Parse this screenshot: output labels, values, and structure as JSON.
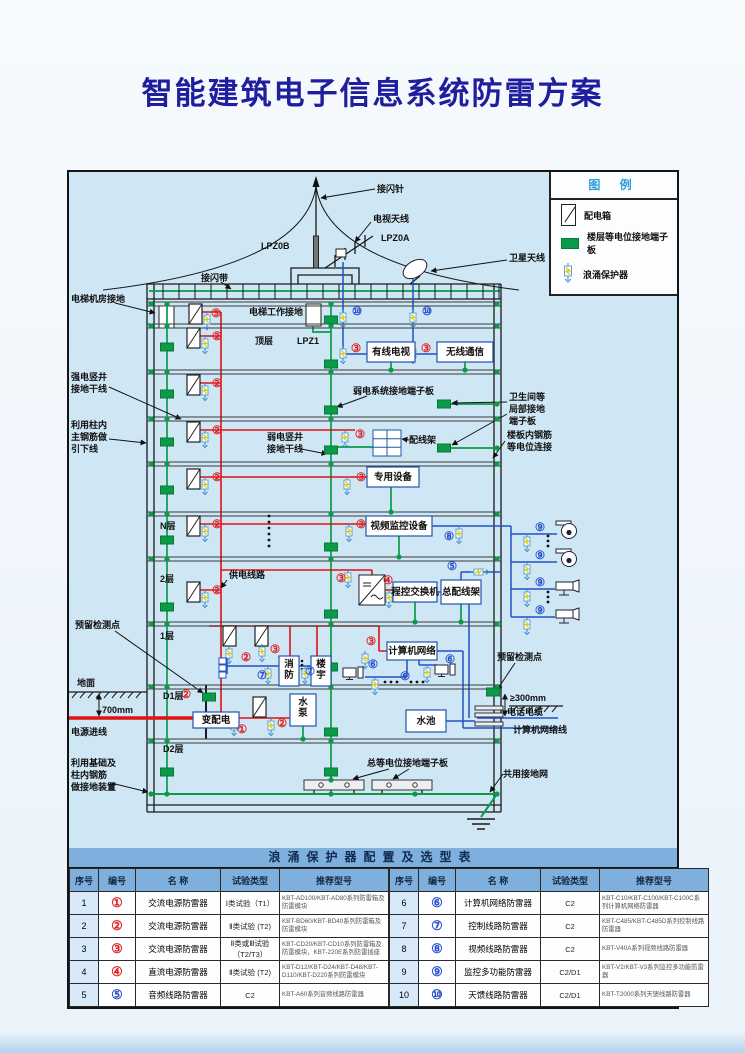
{
  "page": {
    "title": "智能建筑电子信息系统防雷方案"
  },
  "colors": {
    "wire_red": "#e01212",
    "wire_blue": "#2250c8",
    "wire_green": "#0a9a48",
    "marker_red": "#e02020",
    "marker_blue": "#2a50cc",
    "panel_bg": "#cfe7f5",
    "title_color": "#1e1e9e",
    "legend_title_color": "#2b9fd6",
    "table_header_bg": "#7fb0dd",
    "seq_col_bg": "#d8eafa"
  },
  "legend": {
    "title": "图 例",
    "items": [
      {
        "icon": "distribution-box-icon",
        "label": "配电箱"
      },
      {
        "icon": "floor-terminal-icon",
        "label": "楼层等电位接地端子板"
      },
      {
        "icon": "spd-icon",
        "label": "浪涌保护器"
      }
    ]
  },
  "diagram": {
    "slab_ys": [
      130,
      152,
      198,
      245,
      290,
      340,
      385,
      450,
      513,
      567
    ],
    "dot_xs": [
      82,
      262,
      428
    ],
    "riser_dot_x": 98,
    "labels": [
      [
        "接闪针",
        308,
        20
      ],
      [
        "电视天线",
        304,
        50
      ],
      [
        "LPZ0A",
        312,
        69
      ],
      [
        "LPZ0B",
        192,
        77
      ],
      [
        "卫星天线",
        440,
        89
      ],
      [
        "接闪带",
        132,
        109
      ],
      [
        "电梯机房接地",
        2,
        130
      ],
      [
        "电梯工作接地",
        180,
        143
      ],
      [
        "顶层",
        186,
        172
      ],
      [
        "LPZ1",
        228,
        172
      ],
      [
        "强电竖井",
        2,
        208
      ],
      [
        "接地干线",
        2,
        220
      ],
      [
        "利用柱内",
        2,
        256
      ],
      [
        "主钢筋做",
        2,
        268
      ],
      [
        "引下线",
        2,
        280
      ],
      [
        "弱电系统接地端子板",
        284,
        222
      ],
      [
        "弱电竖井",
        198,
        268
      ],
      [
        "接地干线",
        198,
        280
      ],
      [
        "配线架",
        340,
        271
      ],
      [
        "卫生间等",
        440,
        228
      ],
      [
        "局部接地",
        440,
        240
      ],
      [
        "端子板",
        440,
        252
      ],
      [
        "楼板内钢筋",
        438,
        266
      ],
      [
        "等电位连接",
        438,
        278
      ],
      [
        "N层",
        91,
        357
      ],
      [
        "供电线路",
        160,
        406
      ],
      [
        "2层",
        91,
        410
      ],
      [
        "1层",
        91,
        467
      ],
      [
        "D1层",
        94,
        527
      ],
      [
        "D2层",
        94,
        580
      ],
      [
        "预留检测点",
        6,
        456
      ],
      [
        "地面",
        8,
        514
      ],
      [
        "700mm",
        33,
        541
      ],
      [
        "电源进线",
        2,
        563
      ],
      [
        "利用基础及",
        2,
        594
      ],
      [
        "柱内钢筋",
        2,
        606
      ],
      [
        "做接地装置",
        2,
        618
      ],
      [
        "总等电位接地端子板",
        298,
        594
      ],
      [
        "预留检测点",
        428,
        488
      ],
      [
        "≥300mm",
        441,
        529
      ],
      [
        "电话电缆",
        438,
        543
      ],
      [
        "计算机网络线",
        444,
        561
      ],
      [
        "共用接地网",
        434,
        605
      ]
    ],
    "markers": [
      [
        "③",
        147,
        145,
        "r"
      ],
      [
        "⑩",
        288,
        143,
        "b"
      ],
      [
        "⑩",
        358,
        143,
        "b"
      ],
      [
        "②",
        148,
        168,
        "r"
      ],
      [
        "③",
        287,
        180,
        "r"
      ],
      [
        "③",
        357,
        180,
        "r"
      ],
      [
        "②",
        148,
        215,
        "r"
      ],
      [
        "②",
        148,
        262,
        "r"
      ],
      [
        "③",
        291,
        266,
        "r"
      ],
      [
        "②",
        148,
        309,
        "r"
      ],
      [
        "③",
        292,
        309,
        "r"
      ],
      [
        "②",
        148,
        356,
        "r"
      ],
      [
        "③",
        292,
        356,
        "r"
      ],
      [
        "⑧",
        380,
        368,
        "b"
      ],
      [
        "②",
        148,
        422,
        "r"
      ],
      [
        "③",
        272,
        410,
        "r"
      ],
      [
        "④",
        319,
        412,
        "r"
      ],
      [
        "⑤",
        383,
        398,
        "b"
      ],
      [
        "②",
        177,
        489,
        "r"
      ],
      [
        "③",
        206,
        481,
        "r"
      ],
      [
        "③",
        302,
        473,
        "r"
      ],
      [
        "⑦",
        193,
        507,
        "b"
      ],
      [
        "⑦",
        241,
        503,
        "b"
      ],
      [
        "⑥",
        304,
        496,
        "b"
      ],
      [
        "⑥",
        336,
        508,
        "b"
      ],
      [
        "⑥",
        381,
        491,
        "b"
      ],
      [
        "②",
        117,
        526,
        "r"
      ],
      [
        "①",
        173,
        561,
        "r"
      ],
      [
        "②",
        213,
        555,
        "r"
      ],
      [
        "⑨",
        471,
        359,
        "b"
      ],
      [
        "⑨",
        471,
        387,
        "b"
      ],
      [
        "⑨",
        471,
        414,
        "b"
      ],
      [
        "⑨",
        471,
        442,
        "b"
      ]
    ],
    "equipment": [
      [
        "有线电视",
        298,
        170,
        48,
        20,
        0
      ],
      [
        "无线通信",
        368,
        170,
        56,
        20,
        0
      ],
      [
        "专用设备",
        298,
        295,
        52,
        20,
        0
      ],
      [
        "视频监控设备",
        297,
        344,
        66,
        20,
        0
      ],
      [
        "程控交换机",
        324,
        410,
        44,
        20,
        0
      ],
      [
        "总配线架",
        372,
        408,
        40,
        24,
        0
      ],
      [
        "计算机网络",
        318,
        470,
        50,
        18,
        0
      ],
      [
        "水池",
        337,
        538,
        40,
        22,
        0
      ],
      [
        "变配电",
        124,
        540,
        46,
        16,
        0
      ],
      [
        "消防",
        210,
        484,
        20,
        30,
        1
      ],
      [
        "楼宇",
        242,
        484,
        20,
        30,
        1
      ],
      [
        "水泵",
        221,
        522,
        26,
        32,
        1
      ]
    ],
    "dist_boxes": [
      [
        120,
        132
      ],
      [
        118,
        156
      ],
      [
        118,
        203
      ],
      [
        118,
        250
      ],
      [
        118,
        297
      ],
      [
        118,
        344
      ],
      [
        118,
        410
      ],
      [
        154,
        454
      ],
      [
        186,
        454
      ],
      [
        184,
        525
      ]
    ],
    "spds": [
      [
        138,
        140,
        0
      ],
      [
        136,
        164,
        0
      ],
      [
        136,
        211,
        0
      ],
      [
        136,
        258,
        0
      ],
      [
        136,
        305,
        0
      ],
      [
        136,
        352,
        0
      ],
      [
        136,
        418,
        0
      ],
      [
        274,
        138,
        0
      ],
      [
        344,
        138,
        0
      ],
      [
        274,
        174,
        0
      ],
      [
        344,
        174,
        0
      ],
      [
        276,
        258,
        0
      ],
      [
        278,
        305,
        0
      ],
      [
        280,
        352,
        0
      ],
      [
        279,
        398,
        0
      ],
      [
        320,
        418,
        0
      ],
      [
        160,
        474,
        0
      ],
      [
        193,
        472,
        0
      ],
      [
        296,
        479,
        0
      ],
      [
        199,
        494,
        0
      ],
      [
        236,
        494,
        0
      ],
      [
        306,
        505,
        0
      ],
      [
        358,
        493,
        0
      ],
      [
        165,
        546,
        0
      ],
      [
        202,
        546,
        0
      ],
      [
        458,
        362,
        0
      ],
      [
        458,
        390,
        0
      ],
      [
        458,
        417,
        0
      ],
      [
        458,
        445,
        0
      ],
      [
        390,
        354,
        0
      ],
      [
        402,
        400,
        1
      ]
    ],
    "squares": [
      [
        98,
        175
      ],
      [
        98,
        222
      ],
      [
        98,
        270
      ],
      [
        98,
        318
      ],
      [
        98,
        368
      ],
      [
        98,
        435
      ],
      [
        98,
        600
      ],
      [
        262,
        148
      ],
      [
        262,
        192
      ],
      [
        262,
        238
      ],
      [
        262,
        278
      ],
      [
        262,
        375
      ],
      [
        262,
        442
      ],
      [
        262,
        495
      ],
      [
        262,
        560
      ],
      [
        262,
        600
      ],
      [
        375,
        232
      ],
      [
        375,
        276
      ],
      [
        424,
        520
      ],
      [
        140,
        525
      ]
    ],
    "extra_dots": [
      [
        82,
        622
      ],
      [
        98,
        622
      ],
      [
        262,
        622
      ],
      [
        346,
        622
      ],
      [
        428,
        622
      ],
      [
        322,
        198
      ],
      [
        396,
        198
      ],
      [
        322,
        340
      ],
      [
        330,
        385
      ],
      [
        346,
        450
      ],
      [
        392,
        450
      ],
      [
        234,
        567
      ],
      [
        428,
        232
      ],
      [
        428,
        276
      ],
      [
        262,
        608
      ]
    ],
    "cameras": [
      [
        500,
        358,
        "dome"
      ],
      [
        500,
        386,
        "dome"
      ],
      [
        498,
        414,
        "bullet"
      ],
      [
        498,
        442,
        "bullet"
      ]
    ],
    "computers": [
      [
        274,
        496
      ],
      [
        366,
        493
      ]
    ],
    "sensors": [
      [
        150,
        486
      ],
      [
        150,
        493
      ],
      [
        150,
        500
      ]
    ],
    "bus_bars": [
      [
        235,
        608
      ],
      [
        303,
        608
      ]
    ],
    "vdots": [
      [
        200,
        344,
        6,
        6
      ],
      [
        479,
        364,
        5,
        3
      ],
      [
        479,
        420,
        5,
        3
      ]
    ],
    "hdots": [
      [
        316,
        510,
        6,
        3
      ],
      [
        342,
        510,
        6,
        3
      ]
    ]
  },
  "table": {
    "title": "浪涌保护器配置及选型表",
    "headers": [
      "序号",
      "编号",
      "名 称",
      "试验类型",
      "推荐型号"
    ],
    "rows_left": [
      [
        "1",
        "①",
        "r",
        "交流电源防雷器",
        "Ⅰ类试验（T1）",
        "KBT-AD100/KBT-AD80系列防雷箱及防雷模块"
      ],
      [
        "2",
        "②",
        "r",
        "交流电源防雷器",
        "Ⅱ类试验 (T2)",
        "KBT-BD60/KBT-BD40系列防雷箱及防雷模块"
      ],
      [
        "3",
        "③",
        "r",
        "交流电源防雷器",
        "Ⅱ类或Ⅲ试验（T2/T3）",
        "KBT-CD20/KBT-CD10系列防雷箱及防雷模块，KBT-220E系列防雷插座"
      ],
      [
        "4",
        "④",
        "r",
        "直流电源防雷器",
        "Ⅱ类试验 (T2)",
        "KBT-D12/KBT-D24/KBT-D48/KBT-D110/KBT-D220系列防雷模块"
      ],
      [
        "5",
        "⑤",
        "b",
        "音频线路防雷器",
        "C2",
        "KBT-A60系列音频线路防雷器"
      ]
    ],
    "rows_right": [
      [
        "6",
        "⑥",
        "b",
        "计算机网络防雷器",
        "C2",
        "KBT-C10/KBT-C100/KBT-C100C系列计算机网络防雷器"
      ],
      [
        "7",
        "⑦",
        "b",
        "控制线路防雷器",
        "C2",
        "KBT-C485/KBT-C485D系列控制线路防雷器"
      ],
      [
        "8",
        "⑧",
        "b",
        "视频线路防雷器",
        "C2",
        "KBT-V40A系列视频线路防雷器"
      ],
      [
        "9",
        "⑨",
        "b",
        "监控多功能防雷器",
        "C2/D1",
        "KBT-V2/KBT-V3系列监控多功能防雷器"
      ],
      [
        "10",
        "⑩",
        "b",
        "天馈线路防雷器",
        "C2/D1",
        "KBT-T2000系列天馈线路防雷器"
      ]
    ]
  }
}
